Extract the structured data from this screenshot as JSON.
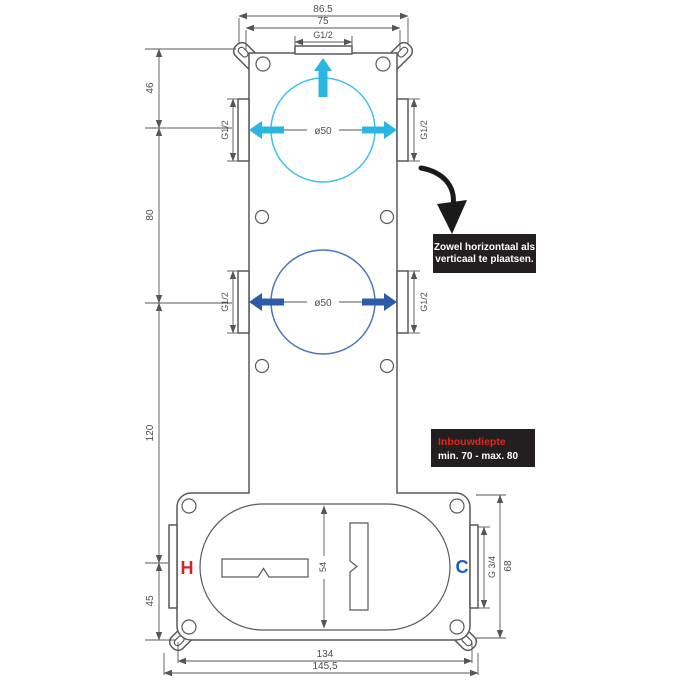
{
  "colors": {
    "line": "#58595b",
    "accent_cyan": "#29b7e2",
    "accent_blue": "#2b5ca8",
    "note_bg": "#231f20",
    "note_red": "#e1251b",
    "hot_red": "#d3222a",
    "cold_blue": "#1b5bc4"
  },
  "dims": {
    "top_outer": "86.5",
    "top_inner": "75",
    "top_port_thread": "G1/2",
    "left_seg_1": "46",
    "left_seg_2": "80",
    "left_seg_3": "120",
    "left_seg_4": "45",
    "c1_left_thread": "G1/2",
    "c1_right_thread": "G1/2",
    "c1_diameter": "ø50",
    "c2_left_thread": "G1/2",
    "c2_right_thread": "G1/2",
    "c2_diameter": "ø50",
    "oval_height": "54",
    "cold_thread": "G 3/4",
    "base_height": "68",
    "bottom_inner": "134",
    "bottom_outer": "145,5"
  },
  "labels": {
    "hot": "H",
    "cold": "C"
  },
  "notes": {
    "placement_line1": "Zowel horizontaal als",
    "placement_line2": "verticaal te plaatsen.",
    "depth_title": "Inbouwdiepte",
    "depth_value": "min. 70 - max. 80"
  }
}
